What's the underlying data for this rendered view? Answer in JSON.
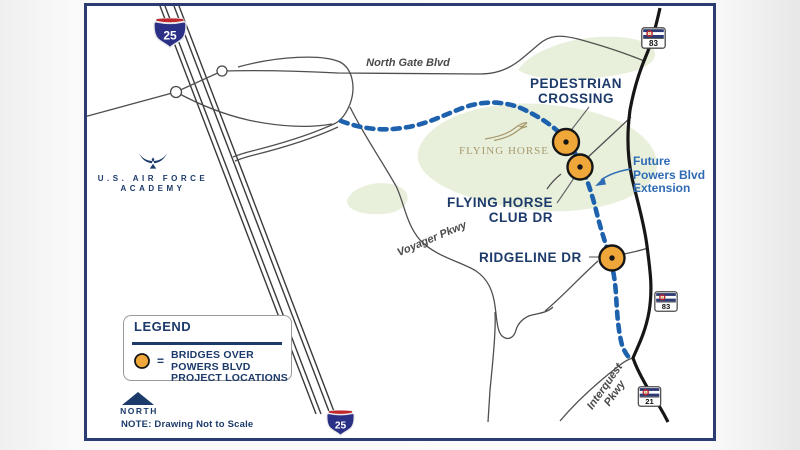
{
  "colors": {
    "navy_text": "#1c3a6a",
    "callout_blue": "#2e6cb5",
    "dashed_route_blue": "#1e62ae",
    "bridge_orange": "#f0a73a",
    "road_gray": "#4f4f4f",
    "road_black": "#161616",
    "green_area": "#e8f0dc",
    "frame_navy": "#2b3c72",
    "interstate_red": "#c0272d",
    "interstate_blue": "#2b3087",
    "logo_tan": "#a89a6e"
  },
  "shields": {
    "i25_top": "25",
    "i25_bottom": "25",
    "co83_top": "83",
    "co83_mid": "83",
    "co21": "21"
  },
  "roads": {
    "north_gate_blvd": "North Gate Blvd",
    "voyager_pkwy": "Voyager Pkwy",
    "interquest_line1": "Interquest",
    "interquest_line2": "Pkwy"
  },
  "landmarks": {
    "academy_line1": "U.S. AIR FORCE",
    "academy_line2": "ACADEMY",
    "flying_horse": "FLYING HORSE"
  },
  "callouts": {
    "pedestrian_line1": "PEDESTRIAN",
    "pedestrian_line2": "CROSSING",
    "flying_horse_club_line1": "FLYING HORSE",
    "flying_horse_club_line2": "CLUB DR",
    "ridgeline": "RIDGELINE DR",
    "future_powers_line1": "Future",
    "future_powers_line2": "Powers Blvd",
    "future_powers_line3": "Extension"
  },
  "legend": {
    "title": "LEGEND",
    "equals": "=",
    "line1": "BRIDGES OVER",
    "line2": "POWERS BLVD",
    "line3": "PROJECT LOCATIONS",
    "north": "NORTH",
    "note": "NOTE: Drawing Not to Scale"
  }
}
